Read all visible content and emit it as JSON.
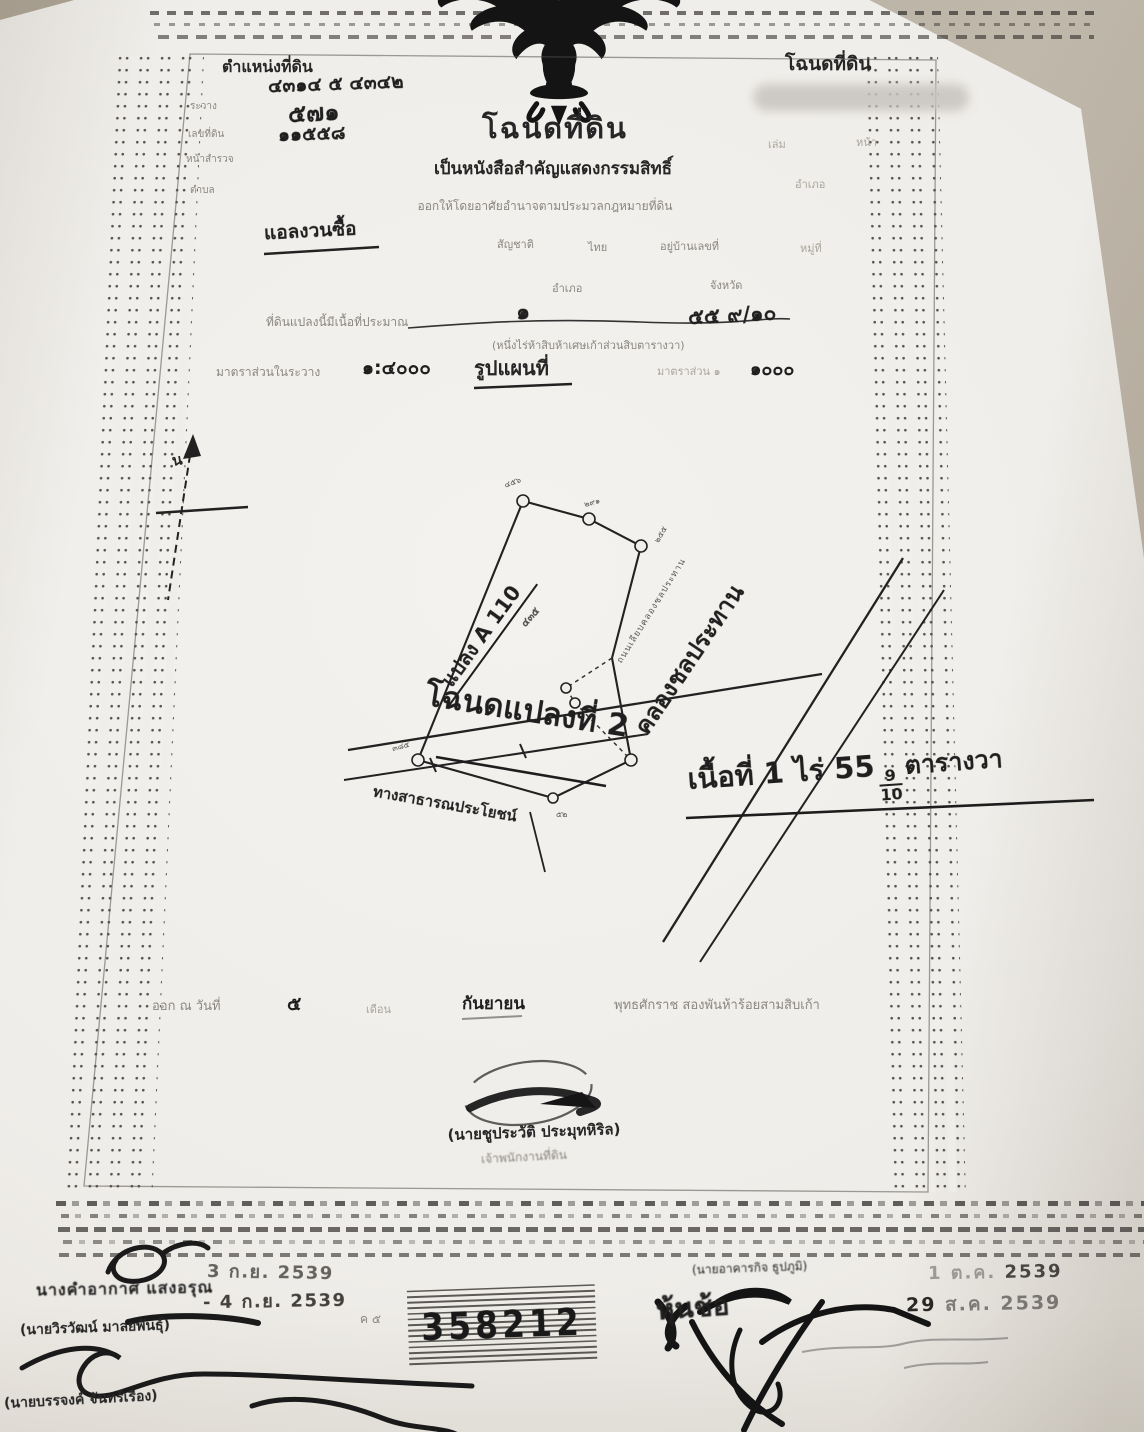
{
  "header_left": {
    "title": "ตำแหน่งที่ดิน",
    "fields": [
      {
        "label": "ระวาง",
        "value": "๔๓๑๔ ๕ ๔๓๔๒"
      },
      {
        "label": "เลขที่ดิน",
        "value": "๕๗๑"
      },
      {
        "label": "หน้าสำรวจ",
        "value": "๑๑๕๕๘"
      },
      {
        "label": "ตำบล",
        "value": ""
      }
    ]
  },
  "header_right": {
    "title": "โฉนดที่ดิน",
    "line2_label_1": "เล่ม",
    "line2_label_2": "หน้า",
    "line3": "อำเภอ"
  },
  "title_block": {
    "title": "โฉนดที่ดิน",
    "subtitle": "เป็นหนังสือสำคัญแสดงกรรมสิทธิ์",
    "issue_line": "ออกให้โดยอาศัยอำนาจตามประมวลกฎหมายที่ดิน"
  },
  "owner": {
    "name": "แอลงวนซื้อ",
    "nationality_label": "สัญชาติ",
    "nationality": "ไทย",
    "address_label": "อยู่บ้านเลขที่",
    "moo_label": "หมู่ที่",
    "amphoe_label": "อำเภอ",
    "changwat_label": "จังหวัด"
  },
  "area_line": {
    "prefix": "ที่ดินแปลงนี้มีเนื้อที่ประมาณ",
    "hand_1": "๑",
    "hand_2": "๕๕ ๙/๑๐",
    "spelled": "(หนึ่งไร่ห้าสิบห้าเศษเก้าส่วนสิบตารางวา)"
  },
  "scale_line": {
    "label": "มาตราส่วนในระวาง",
    "scale_1": "๑:๔๐๐๐",
    "map_title": "รูปแผนที่",
    "scale2_label": "มาตราส่วน ๑",
    "scale_2": "๑๐๐๐"
  },
  "map": {
    "north": "น",
    "plot_label": "แปลง A 110",
    "plot_number": "๔๓๕",
    "deed_note": "โฉนดแปลงที่ 2",
    "canal": "คลองชลประทาน",
    "road_small": "ถนนเลียบคลองชลประทาน",
    "road_bottom": "ทางสาธารณประโยชน์",
    "vertex_numbers": [
      "๔๕๖",
      "๒๙๑",
      "๒๕๕",
      "๓๘๕",
      "๕๒"
    ]
  },
  "area_note": {
    "prefix": "เนื้อที่ 1 ไร่ 55",
    "num": "9",
    "den": "10",
    "suffix": "ตารางวา"
  },
  "issue": {
    "l1": "ออก ณ วันที่",
    "day": "๕",
    "l2": "เดือน",
    "month": "กันยายน",
    "l3": "พุทธศักราช สองพันห้าร้อยสามสิบเก้า"
  },
  "signer": {
    "name": "(นายชูประวัติ ประมุทหิริล)",
    "title": "เจ้าพนักงานที่ดิน"
  },
  "footer": {
    "left_name_stamp": "นางคำอากาศ แสงอรุณ",
    "date_stamp_1": "3 ก.ย. 2539",
    "date_stamp_2": "- 4 ก.ย. 2539",
    "left_name_2": "(นายวิรวัฒน์ มาลยพันธุ์)",
    "left_name_3": "(นายบรรจงค์ จันทร์เรือง)",
    "check_note": "ค ๕",
    "serial": "358212",
    "right_name": "(นายอาคารกิจ ธูปภูมิ)",
    "date_stamp_3_prefix": "1 ต.ค.",
    "date_stamp_3_year": "2539",
    "date_stamp_4_day": "29",
    "date_stamp_4_rest": "ส.ค. 2539",
    "right_hand_note": "หุ้นช้อ"
  }
}
